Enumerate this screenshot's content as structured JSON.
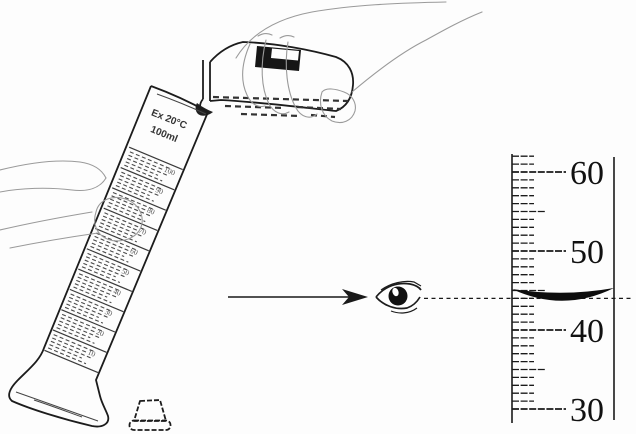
{
  "figure": {
    "description": "Pouring liquid from a reagent bottle into a tilted 100 ml measuring cylinder, with an eye reading the meniscus on a magnified scale",
    "colors": {
      "paper": "#fdfdfd",
      "ink": "#1c1c1c",
      "sketch": "#9a9a9a",
      "label_black": "#161616"
    }
  },
  "cylinder": {
    "marking_line1": "Ex 20°C",
    "marking_line2": "100ml",
    "scale_labels": [
      "100",
      "90",
      "80",
      "70",
      "60",
      "50",
      "40",
      "30",
      "20",
      "10"
    ]
  },
  "magnified_scale": {
    "unit_labels": [
      "60",
      "50",
      "40",
      "30"
    ],
    "min": 30,
    "max": 62,
    "major_step": 10,
    "mid_step": 5,
    "minor_step": 1,
    "meniscus_value": 44
  }
}
